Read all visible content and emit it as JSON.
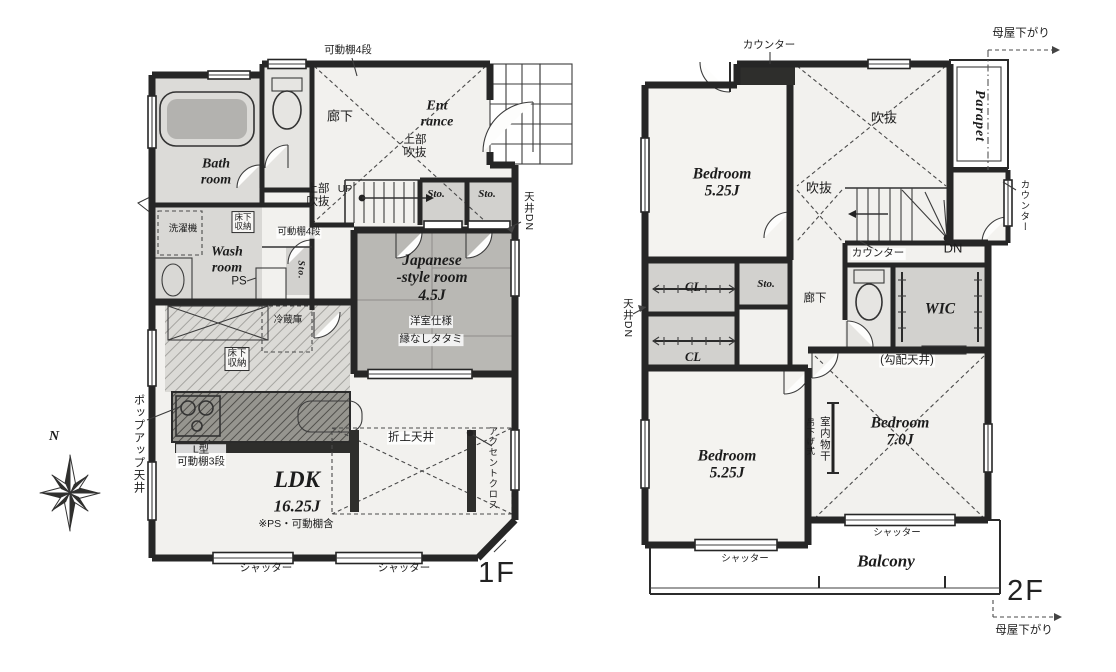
{
  "compass": {
    "north_label": "N"
  },
  "floor1": {
    "floor_label": "1F",
    "rooms": {
      "bathroom": "Bath\nroom",
      "washroom": "Wash\nroom",
      "entrance": "Ent\nrance",
      "corridor": "廊下",
      "japanese_room": "Japanese\n-style room\n4.5J",
      "japanese_room_note1": "洋室仕様",
      "japanese_room_note2": "縁なしタタミ",
      "ldk": "LDK",
      "ldk_size": "16.25J",
      "ldk_note": "※PS・可動棚含",
      "storage1": "Sto.",
      "storage2": "Sto.",
      "storage_small": "Sto.",
      "ps": "PS"
    },
    "annotations": {
      "shelf_top": "可動棚4段",
      "shelf_mid": "可動棚4段",
      "upper_void1": "上部\n吹抜",
      "upper_void2": "上部\n吹抜",
      "up": "UP",
      "washer": "洗濯機",
      "underfloor_storage1": "床下\n収納",
      "underfloor_storage2": "床下\n収納",
      "fridge": "冷蔵庫",
      "ceiling_down": "天井DN",
      "popup_ceiling": "ポップアップ天井",
      "l_shelf": "L型\n可動棚3段",
      "coffered_ceiling": "折上天井",
      "accent_cloth": "アクセントクロス",
      "shutter_left": "シャッター",
      "shutter_right": "シャッター"
    }
  },
  "floor2": {
    "floor_label": "2F",
    "rooms": {
      "bedroom1": "Bedroom\n5.25J",
      "bedroom2": "Bedroom\n5.25J",
      "bedroom3": "Bedroom\n7.0J",
      "wic": "WIC",
      "closet1": "CL",
      "closet2": "CL",
      "storage": "Sto.",
      "corridor": "廊下",
      "balcony": "Balcony",
      "parapet": "Parapet"
    },
    "annotations": {
      "counter_top": "カウンター",
      "counter_mid": "カウンター",
      "counter_right": "カウンター",
      "void1": "吹抜",
      "void2": "吹抜",
      "dn": "DN",
      "ceiling_down": "天井DN",
      "sloped_ceiling": "(勾配天井)",
      "indoor_drying": "室内物干",
      "hanging_type": "吊下げ式",
      "shutter_left": "シャッター",
      "shutter_right": "シャッター",
      "roof_lower_top": "母屋下がり",
      "roof_lower_bottom": "母屋下がり"
    }
  }
}
